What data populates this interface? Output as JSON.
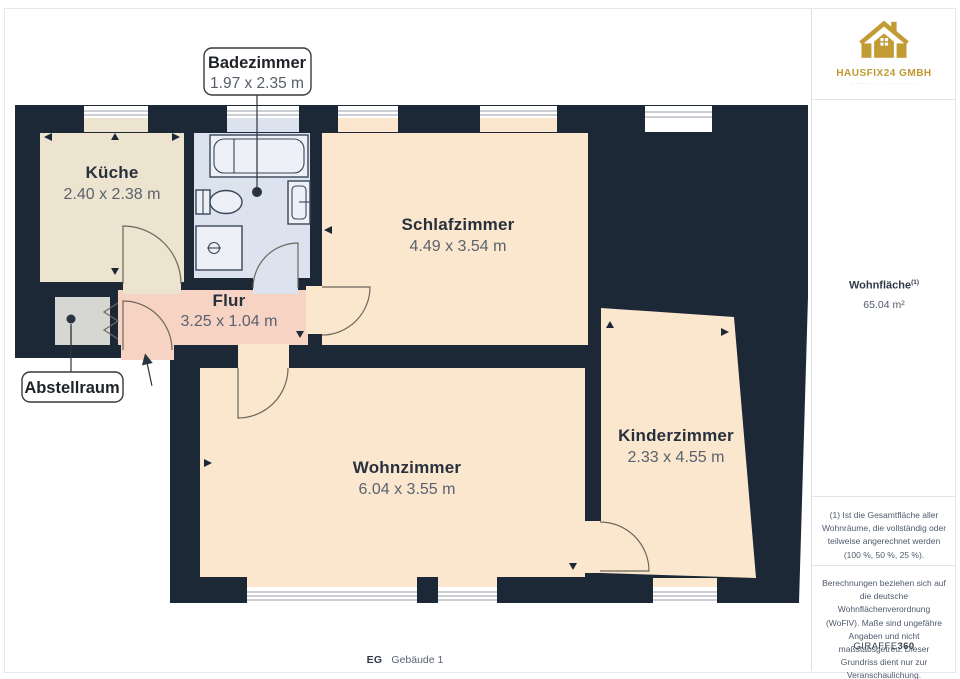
{
  "plan": {
    "rooms": [
      {
        "id": "kueche",
        "name": "Küche",
        "dims": "2.40 x 2.38 m"
      },
      {
        "id": "badezimmer",
        "name": "Badezimmer",
        "dims": "1.97 x 2.35 m"
      },
      {
        "id": "schlafzimmer",
        "name": "Schlafzimmer",
        "dims": "4.49 x 3.54 m"
      },
      {
        "id": "flur",
        "name": "Flur",
        "dims": "3.25 x 1.04 m"
      },
      {
        "id": "abstellraum",
        "name": "Abstellraum",
        "dims": ""
      },
      {
        "id": "wohnzimmer",
        "name": "Wohnzimmer",
        "dims": "6.04 x 3.55 m"
      },
      {
        "id": "kinderzimmer",
        "name": "Kinderzimmer",
        "dims": "2.33 x 4.55 m"
      }
    ],
    "colors": {
      "wall": "#1c2836",
      "kueche": "#ede4cf",
      "badezimmer": "#dce2ee",
      "peach": "#fbe6ce",
      "flur": "#f6d3c2",
      "abstellraum": "#d6d6d2",
      "brand_gold": "#c29b35"
    }
  },
  "sidebar": {
    "brand": {
      "name": "HAUSFIX24 GMBH",
      "tagline": "··········· · · ···········"
    },
    "area": {
      "label": "Wohnfläche",
      "superscript": "(1)",
      "value": "65.04 m²"
    },
    "footnote_area": "(1) Ist die Gesamtfläche aller Wohnräume, die vollständig oder teilweise angerechnet werden (100 %, 50 %, 25 %).",
    "footnote_disclaimer": "Berechnungen beziehen sich auf die deutsche Wohnflächenverordnung (WoFlV). Maße sind ungefähre Angaben und nicht maßstabsgetreu. Dieser Grundriss dient nur zur Veranschaulichung.",
    "credit": {
      "regular": "GIRAFFE",
      "bold": "360"
    }
  },
  "footer": {
    "floor_label": "EG",
    "building_label": "Gebäude 1"
  }
}
